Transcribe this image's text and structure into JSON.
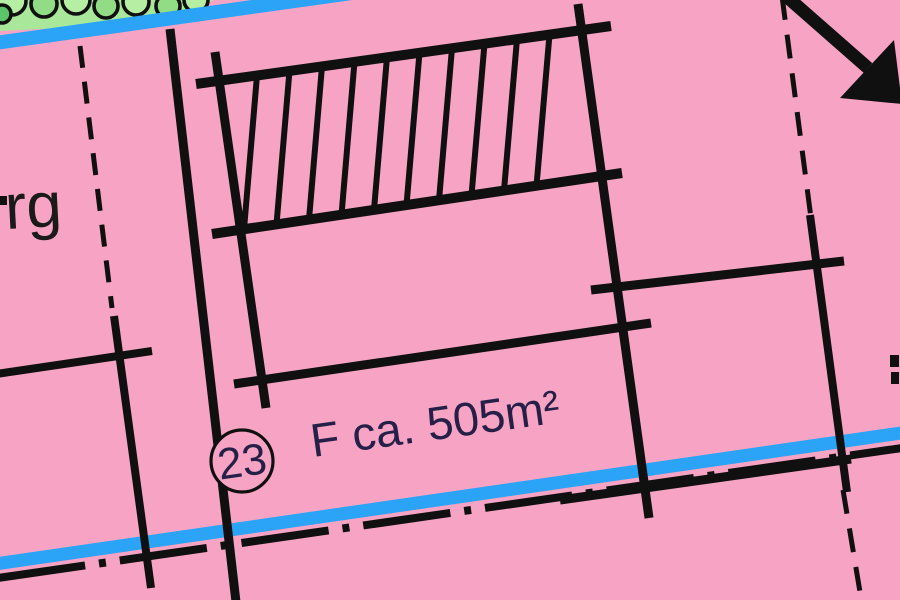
{
  "labels": {
    "street_name_fragment": "rg",
    "parcel_number": "23",
    "area_label": "F ca. 505m²"
  },
  "colors": {
    "background_pink": "#F7A4C4",
    "road_blue": "#2BA3F7",
    "green_light": "#A9E89B",
    "tree_fill_light": "#B6EFA3",
    "tree_fill_mid": "#92DC86",
    "tree_fill_dark": "#5CC468",
    "line_black": "#101010",
    "label_navy": "#262048",
    "text_black": "#1A1A1A"
  },
  "map": {
    "green_area": {
      "polygon": [
        [
          0,
          0
        ],
        [
          214,
          0
        ],
        [
          196,
          8
        ],
        [
          150,
          18
        ],
        [
          80,
          27
        ],
        [
          0,
          31
        ]
      ],
      "tree_circles": [
        {
          "cx": 12,
          "cy": 1,
          "r": 14,
          "fill": "tree_fill_light"
        },
        {
          "cx": 44,
          "cy": 4,
          "r": 13,
          "fill": "tree_fill_mid"
        },
        {
          "cx": 76,
          "cy": 0,
          "r": 14,
          "fill": "tree_fill_light"
        },
        {
          "cx": 106,
          "cy": 6,
          "r": 12,
          "fill": "tree_fill_mid"
        },
        {
          "cx": 136,
          "cy": 2,
          "r": 13,
          "fill": "tree_fill_light"
        },
        {
          "cx": 168,
          "cy": 6,
          "r": 12,
          "fill": "tree_fill_mid"
        },
        {
          "cx": 196,
          "cy": 0,
          "r": 12,
          "fill": "tree_fill_light"
        },
        {
          "cx": 2,
          "cy": 14,
          "r": 9,
          "fill": "tree_fill_dark"
        }
      ]
    },
    "roads": [
      {
        "id": "upper-road-line",
        "x1": -12,
        "y1": 44,
        "x2": 402,
        "y2": -14,
        "w": 14
      },
      {
        "id": "lower-road-line",
        "x1": -12,
        "y1": 565,
        "x2": 908,
        "y2": 432,
        "w": 13
      }
    ],
    "dash_dot_line": {
      "id": "plan-area-boundary-line",
      "x1": -2,
      "y1": 578,
      "x2": 902,
      "y2": 448,
      "w": 8,
      "dash": "88 14 7 14"
    },
    "solid_lines": [
      {
        "id": "boundary-left-vertical",
        "x1": 170,
        "y1": 29,
        "x2": 236,
        "y2": 602,
        "w": 9
      },
      {
        "id": "envelope-left-side",
        "x1": 215,
        "y1": 52,
        "x2": 266,
        "y2": 408,
        "w": 9
      },
      {
        "id": "envelope-right-side",
        "x1": 578,
        "y1": 4,
        "x2": 649,
        "y2": 518,
        "w": 9
      },
      {
        "id": "hatch-top-rail",
        "x1": 196,
        "y1": 84,
        "x2": 611,
        "y2": 26,
        "w": 10
      },
      {
        "id": "hatch-bottom-rail",
        "x1": 212,
        "y1": 234,
        "x2": 622,
        "y2": 173,
        "w": 10
      },
      {
        "id": "envelope-bottom-rail",
        "x1": 234,
        "y1": 384,
        "x2": 651,
        "y2": 323,
        "w": 9
      },
      {
        "id": "parcel-line-right-horizontal",
        "x1": 591,
        "y1": 290,
        "x2": 844,
        "y2": 261,
        "w": 9
      },
      {
        "id": "boundary-solid-right-segment",
        "x1": 810,
        "y1": 215,
        "x2": 847,
        "y2": 492,
        "w": 8
      },
      {
        "id": "boundary-along-road-segment",
        "x1": 560,
        "y1": 500,
        "x2": 851,
        "y2": 459,
        "w": 9
      },
      {
        "id": "left-cross-horizontal",
        "x1": -4,
        "y1": 374,
        "x2": 152,
        "y2": 351,
        "w": 8
      },
      {
        "id": "left-cross-vertical-lower",
        "x1": 114,
        "y1": 316,
        "x2": 151,
        "y2": 588,
        "w": 8
      }
    ],
    "dashed_lines": [
      {
        "id": "parcel-dashed-left",
        "x1": 80,
        "y1": 46,
        "x2": 112,
        "y2": 308,
        "w": 5,
        "dash": "22 14"
      },
      {
        "id": "plan-boundary-dashed-upper-right",
        "x1": 782,
        "y1": -4,
        "x2": 811,
        "y2": 218,
        "w": 5,
        "dash": "24 15"
      },
      {
        "id": "plan-boundary-dashed-lower-right",
        "x1": 843,
        "y1": 490,
        "x2": 862,
        "y2": 604,
        "w": 5,
        "dash": "24 15"
      }
    ],
    "hatch_rungs": {
      "start_x": 257,
      "step": 32.5,
      "count": 10,
      "lean": 13,
      "w": 6
    },
    "arrow": {
      "shaft": {
        "x1": 770,
        "y1": -18,
        "x2": 868,
        "y2": 68,
        "w": 13
      },
      "head": [
        [
          840,
          98
        ],
        [
          894,
          40
        ],
        [
          902,
          104
        ]
      ]
    },
    "parcel_circle": {
      "cx": 242,
      "cy": 461,
      "r": 31,
      "stroke_w": 3.2
    },
    "texts": [
      {
        "id": "street-name-fragment",
        "bind": "labels.street_name_fragment",
        "x": 6,
        "y": 229,
        "size": 64,
        "rotate": -3,
        "color": "text_black",
        "anchor": "start"
      },
      {
        "id": "area-label",
        "bind": "labels.area_label",
        "x": 313,
        "y": 457,
        "size": 47,
        "rotate": -8,
        "color": "label_navy",
        "anchor": "start"
      },
      {
        "id": "parcel-number",
        "bind": "labels.parcel_number",
        "x": 242,
        "y": 461,
        "size": 44,
        "rotate": -8,
        "color": "label_navy",
        "anchor": "middle"
      }
    ],
    "fragments": [
      {
        "id": "clipped-letter-fragment-left",
        "x": 0,
        "y": 196,
        "w": 7,
        "h": 9
      },
      {
        "id": "clipped-text-fragment-right-1",
        "x": 890,
        "y": 355,
        "w": 9,
        "h": 12
      },
      {
        "id": "clipped-text-fragment-right-2",
        "x": 891,
        "y": 372,
        "w": 8,
        "h": 12
      }
    ]
  }
}
